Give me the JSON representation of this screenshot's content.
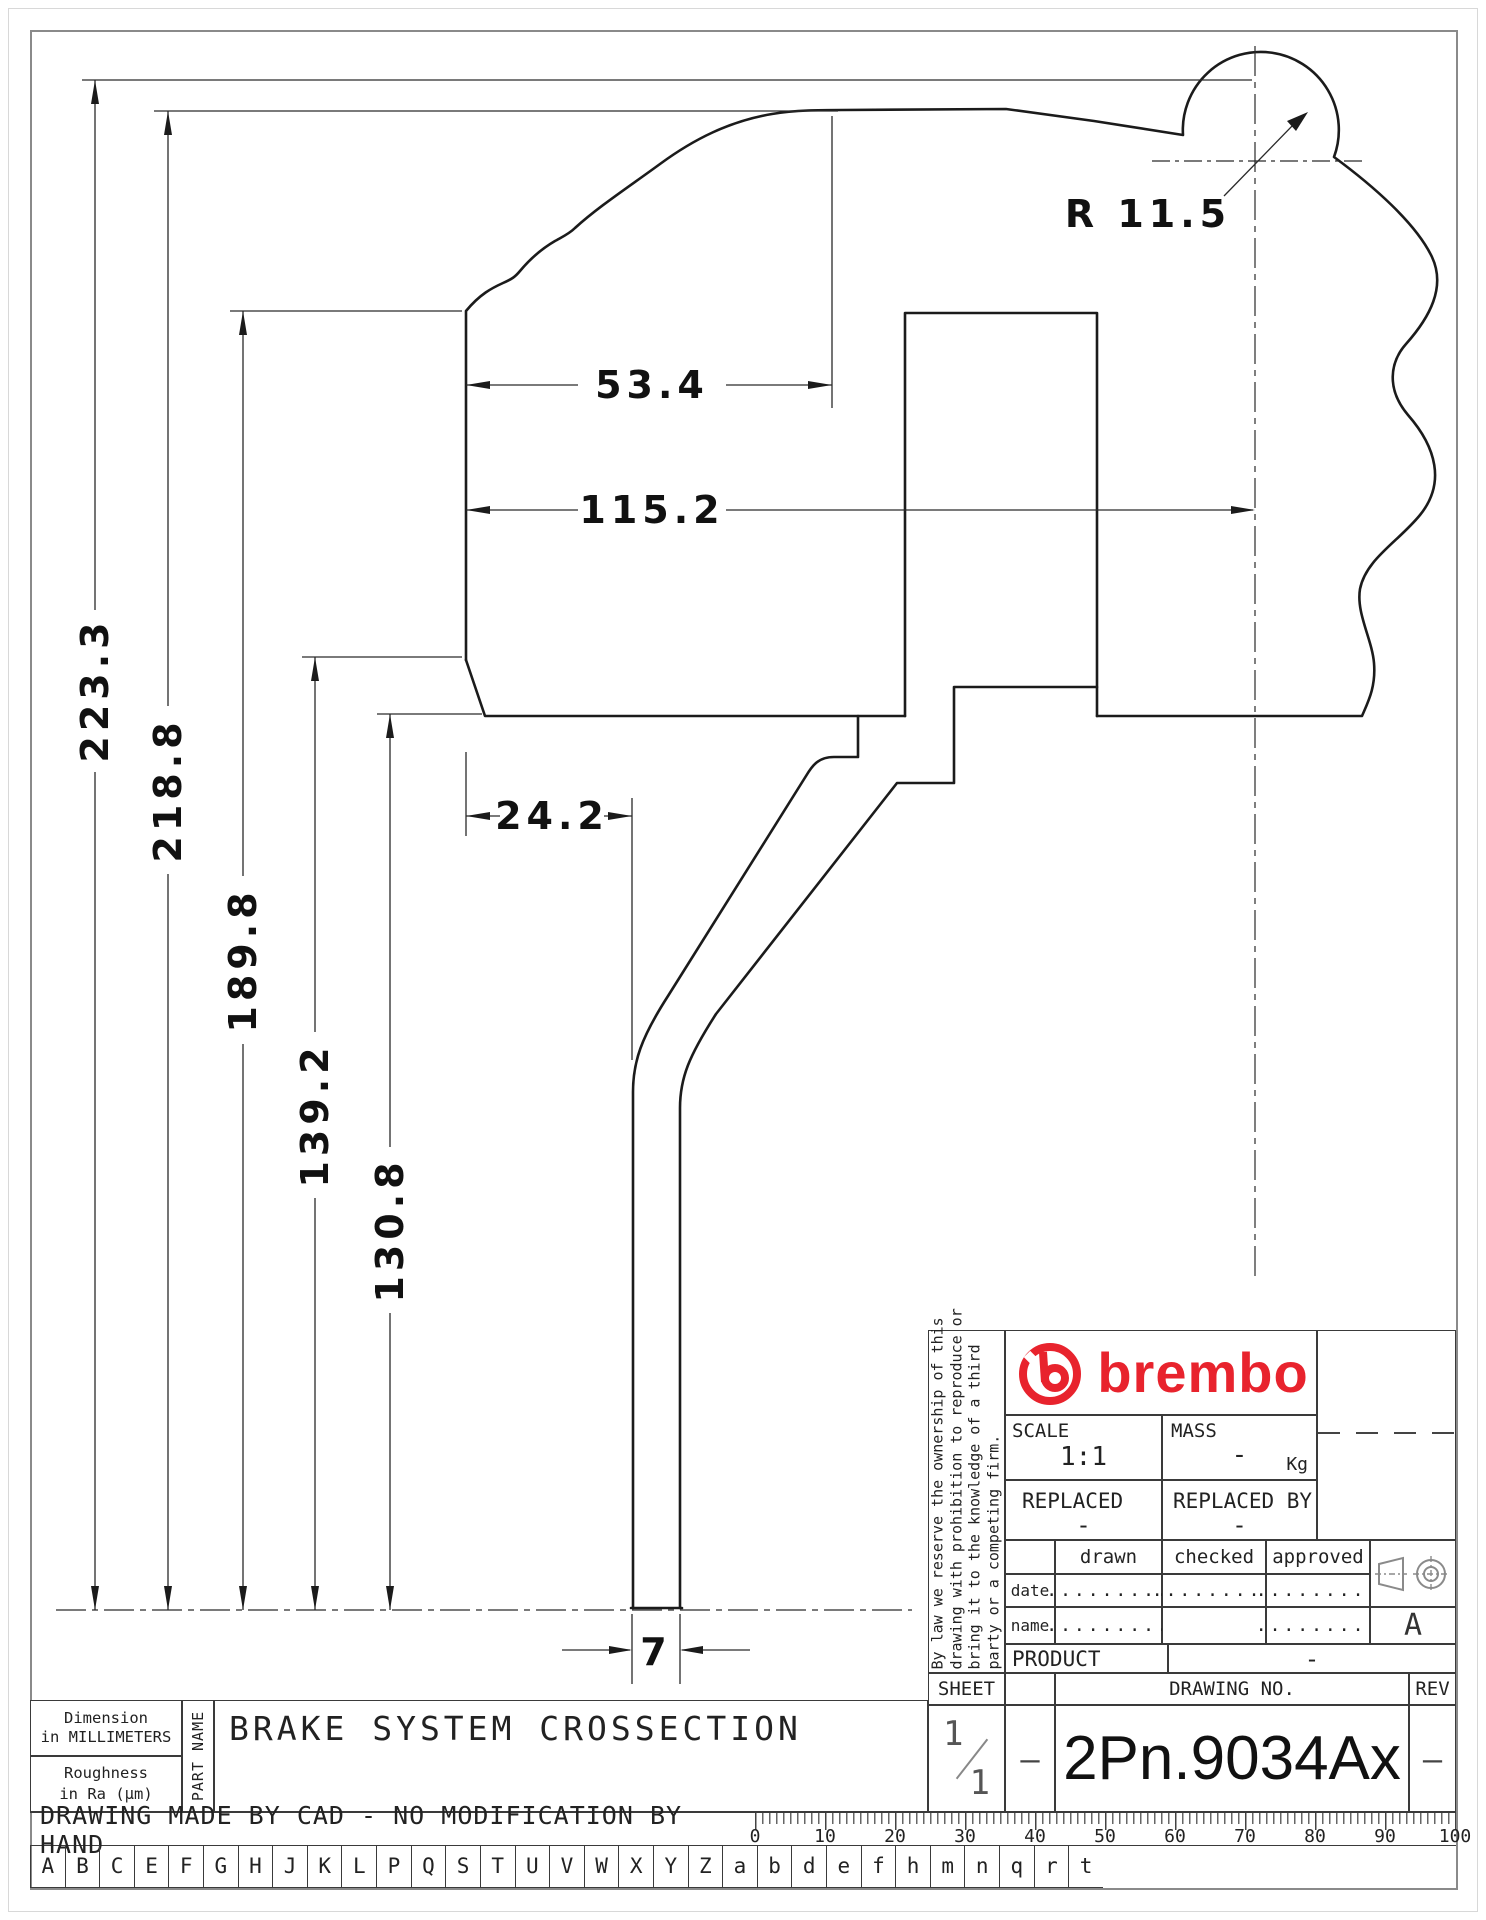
{
  "drawing": {
    "dims": {
      "h_total": "223.3",
      "h_top_flat": "218.8",
      "h_slot": "189.8",
      "h_chamfer": "139.2",
      "h_bottom_edge": "130.8",
      "w_flat": "53.4",
      "w_center": "115.2",
      "w_leg_offset": "24.2",
      "w_leg": "7",
      "radius": "R 11.5"
    }
  },
  "copyright": {
    "line1": "By law we reserve the ownership of this",
    "line2": "drawing with prohibition to reproduce or",
    "line3": "bring it to the knowledge of a third",
    "line4": "party or a competing firm."
  },
  "title_block": {
    "brand": "brembo",
    "scale_label": "SCALE",
    "scale_value": "1:1",
    "mass_label": "MASS",
    "mass_value": "-",
    "mass_unit": "Kg",
    "replaced_label": "REPLACED",
    "replaced_value": "-",
    "replaced_by_label": "REPLACED BY",
    "replaced_by_value": "-",
    "col_drawn": "drawn",
    "col_checked": "checked",
    "col_approved": "approved",
    "row_date": "date",
    "row_name": "name",
    "date_drawn": ".........",
    "date_checked": ".........",
    "date_approved": ".........",
    "name_drawn": ".........",
    "name_approved": ".........",
    "product_spec_label": "PRODUCT SPEC.",
    "product_spec_value": "-",
    "sheet_label": "SHEET",
    "sheet_num": "1",
    "sheet_den": "1",
    "sheet_extra": "–",
    "drawing_no_label": "DRAWING NO.",
    "drawing_no": "2Pn.9034Ax",
    "rev_label": "REV",
    "rev_value": "–",
    "size_letter": "A"
  },
  "part_block": {
    "dimension_note_1": "Dimension",
    "dimension_note_2": "in MILLIMETERS",
    "roughness_note_1": "Roughness",
    "roughness_note_2": "in Ra (μm)",
    "part_name_label": "PART NAME",
    "part_name": "BRAKE SYSTEM CROSSECTION"
  },
  "footer": {
    "cad_note": "DRAWING MADE BY CAD - NO MODIFICATION BY HAND",
    "ruler_numbers": [
      "0",
      "10",
      "20",
      "30",
      "40",
      "50",
      "60",
      "70",
      "80",
      "90",
      "100"
    ],
    "alphabet": [
      "A",
      "B",
      "C",
      "E",
      "F",
      "G",
      "H",
      "J",
      "K",
      "L",
      "P",
      "Q",
      "S",
      "T",
      "U",
      "V",
      "W",
      "X",
      "Y",
      "Z",
      "a",
      "b",
      "d",
      "e",
      "f",
      "h",
      "m",
      "n",
      "q",
      "r",
      "t"
    ]
  }
}
